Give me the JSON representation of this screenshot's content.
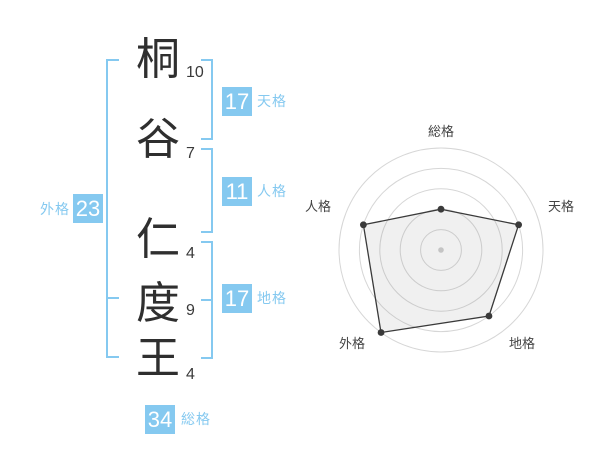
{
  "name": {
    "characters": [
      {
        "char": "桐",
        "strokes": "10"
      },
      {
        "char": "谷",
        "strokes": "7"
      },
      {
        "char": "仁",
        "strokes": "4"
      },
      {
        "char": "度",
        "strokes": "9"
      },
      {
        "char": "王",
        "strokes": "4"
      }
    ]
  },
  "kaku": {
    "tenkaku": {
      "label": "天格",
      "value": "17"
    },
    "jinkaku": {
      "label": "人格",
      "value": "11"
    },
    "chikaku": {
      "label": "地格",
      "value": "17"
    },
    "gaikaku": {
      "label": "外格",
      "value": "23"
    },
    "soukaku": {
      "label": "総格",
      "value": "34"
    }
  },
  "colors": {
    "accent_blue": "#85c9f0",
    "name_text": "#2f2f2f",
    "chart_grid": "#d6d6d6",
    "chart_line": "#3a3a3a",
    "chart_fill": "rgba(130,130,130,0.12)",
    "chart_dot": "#3a3a3a",
    "chart_center_dot": "#c4c4c4"
  },
  "chart_data": {
    "type": "radar",
    "categories": [
      "総格",
      "天格",
      "地格",
      "外格",
      "人格"
    ],
    "values": [
      40,
      80,
      80,
      100,
      80
    ],
    "max": 100,
    "ring_count": 5,
    "grid_shape": "concentric-circles",
    "radial_spokes": false,
    "legend": "none",
    "title": ""
  }
}
